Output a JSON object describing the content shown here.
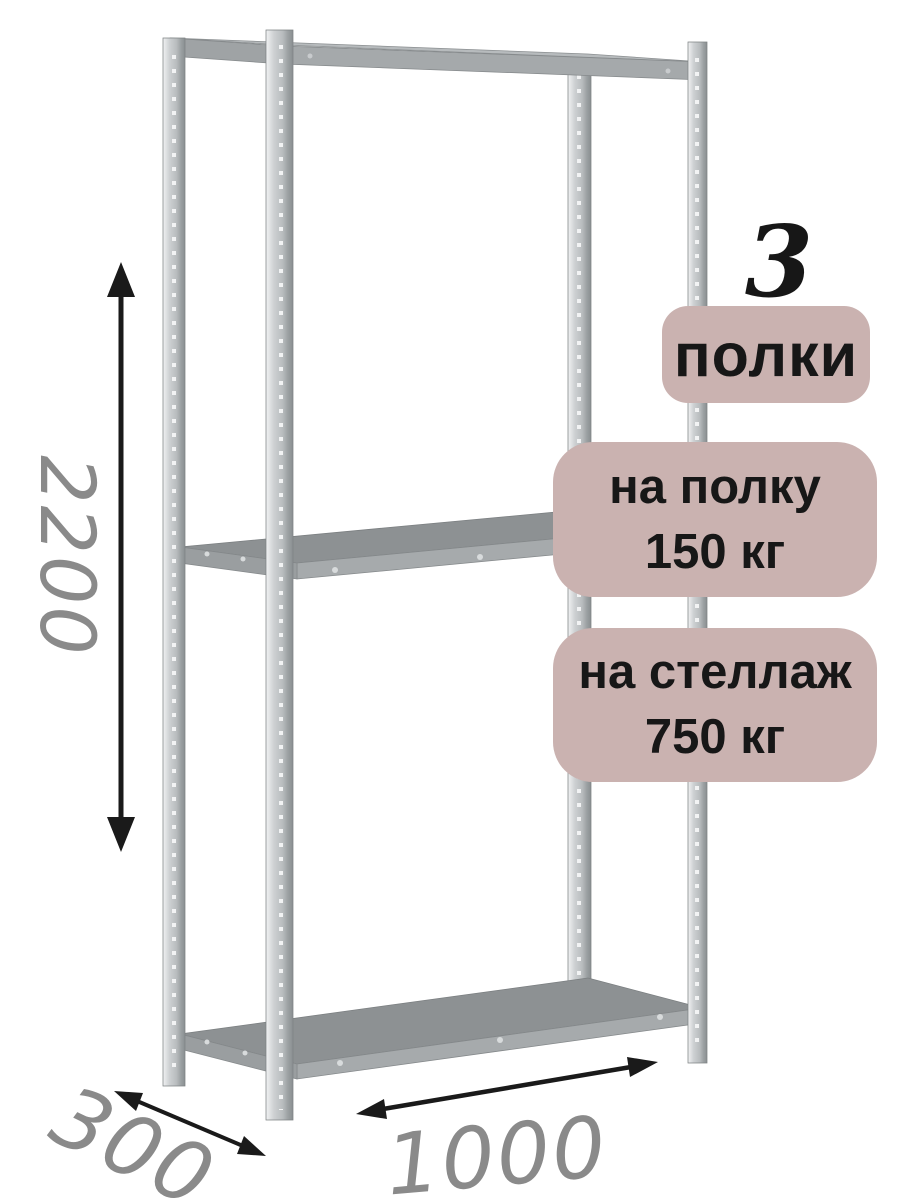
{
  "badges": {
    "count": {
      "value": "3",
      "label": "полки"
    },
    "shelf_load": {
      "line1": "на полку",
      "line2": "150 кг"
    },
    "rack_load": {
      "line1": "на стеллаж",
      "line2": "750 кг"
    }
  },
  "dimensions": {
    "height_mm": "2200",
    "depth_mm": "300",
    "width_mm": "1000"
  },
  "colors": {
    "background": "#ffffff",
    "badge_background": "#cab2b0",
    "badge_text": "#171717",
    "dimension_text": "#8a8a8a",
    "arrow": "#1a1a1a",
    "metal_light": "#f1f2f3",
    "metal_mid": "#c0c4c6",
    "metal_dark": "#8d9193"
  }
}
